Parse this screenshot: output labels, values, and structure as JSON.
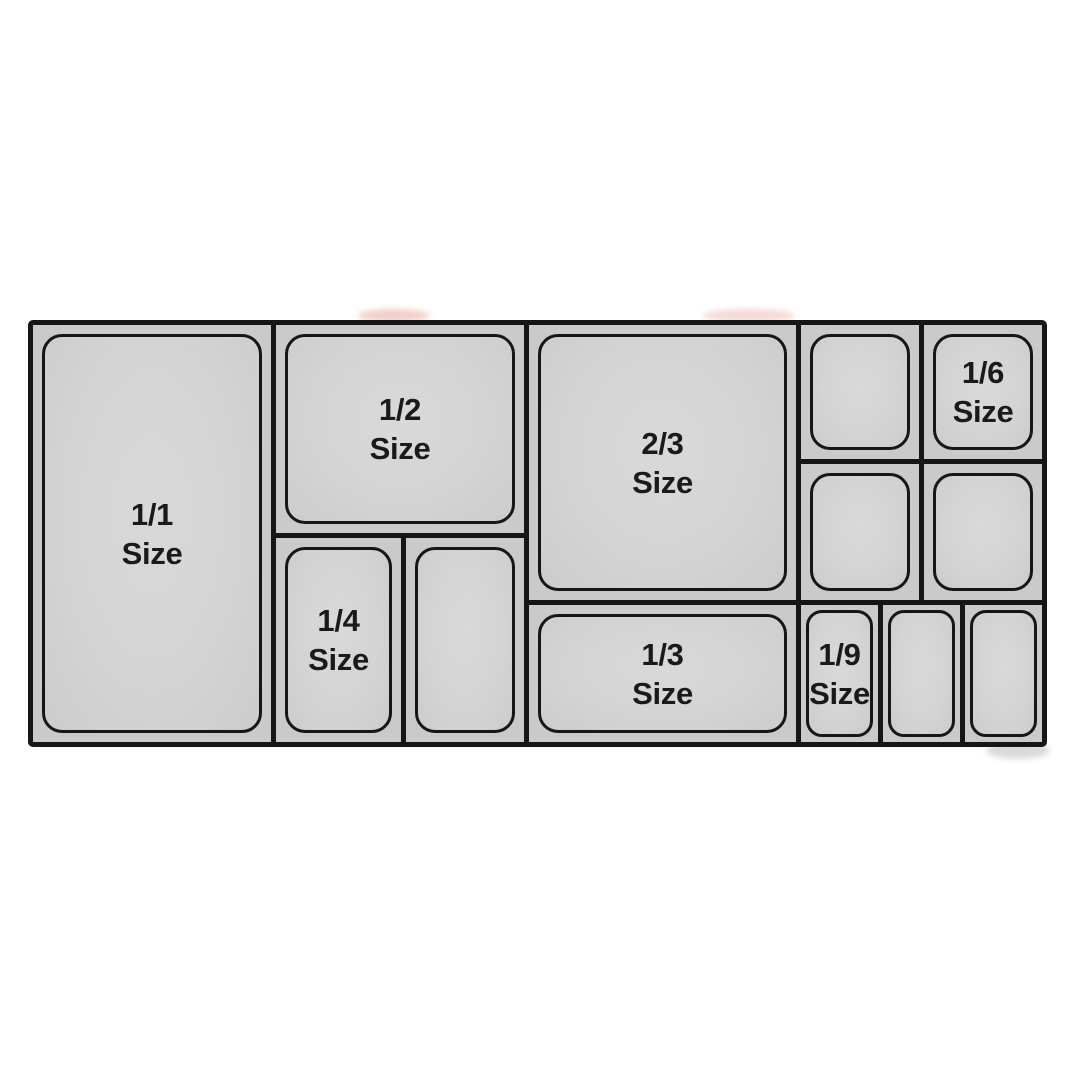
{
  "colors": {
    "background": "#ffffff",
    "pan_fill": "#d3d4d3",
    "pan_margin_fill": "#c9cac9",
    "line": "#161616",
    "text": "#1a1a1a"
  },
  "pans": {
    "full": {
      "line1": "1/1",
      "line2": "Size"
    },
    "half": {
      "line1": "1/2",
      "line2": "Size"
    },
    "two_thirds": {
      "line1": "2/3",
      "line2": "Size"
    },
    "third": {
      "line1": "1/3",
      "line2": "Size"
    },
    "quarter": {
      "line1": "1/4",
      "line2": "Size"
    },
    "sixth": {
      "line1": "1/6",
      "line2": "Size"
    },
    "ninth": {
      "line1": "1/9",
      "line2": "Size"
    }
  }
}
